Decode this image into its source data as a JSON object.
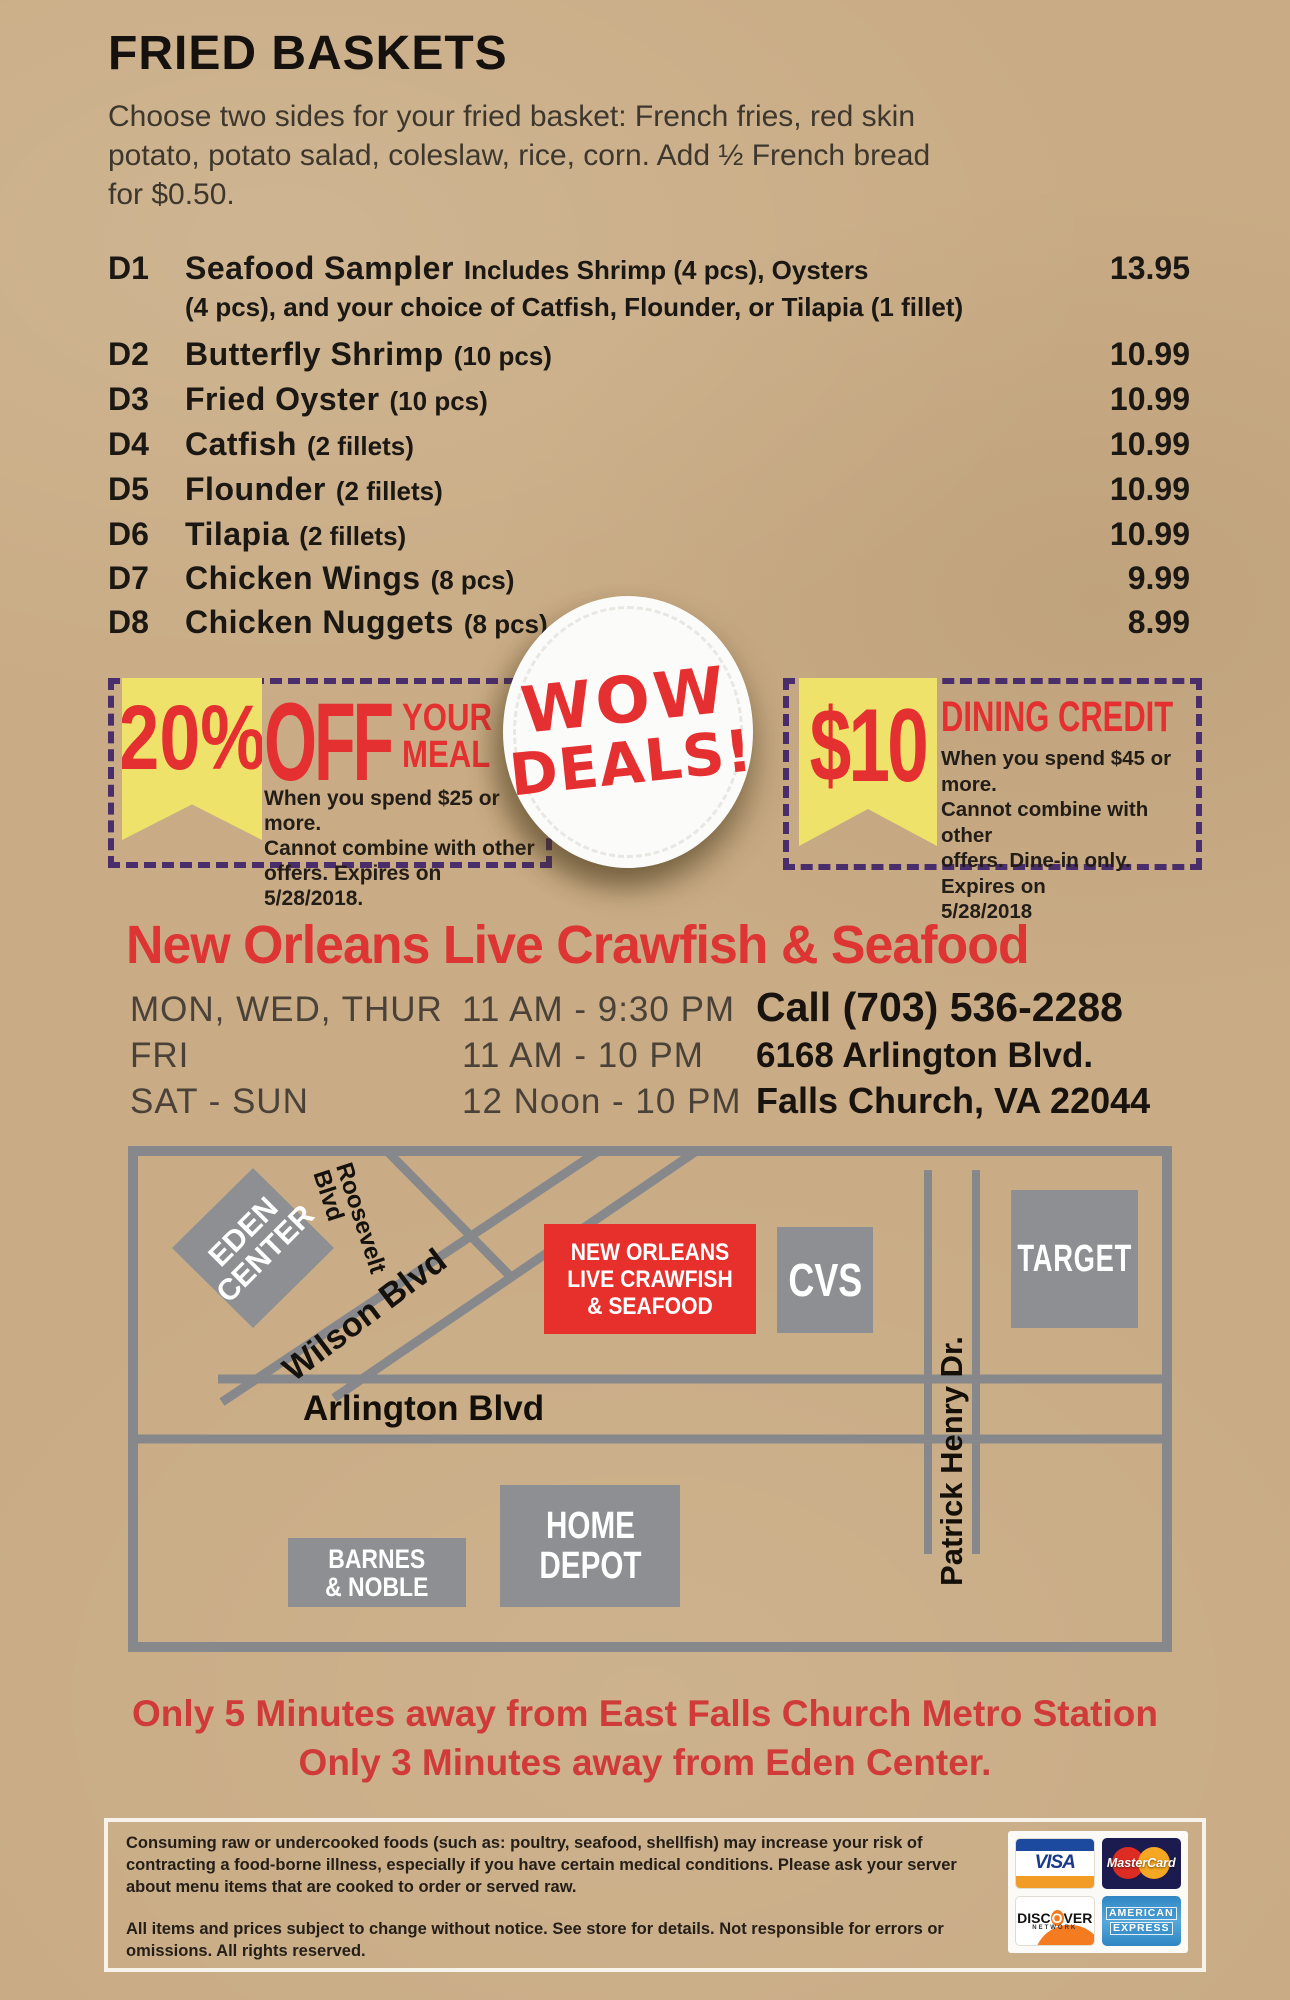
{
  "colors": {
    "accent_red": "#e43030",
    "coupon_yellow": "#efe26a",
    "coupon_purple": "#4a2d6b",
    "map_grey": "#8d8f92",
    "kraft_bg": "#c9ac85"
  },
  "fried_baskets": {
    "title": "FRIED BASKETS",
    "intro": [
      "Choose two sides for your fried basket: French fries, red skin",
      "potato, potato salad, coleslaw, rice, corn.  Add ½ French bread",
      "for $0.50."
    ],
    "items": [
      {
        "code": "D1",
        "name": "Seafood Sampler",
        "desc": "Includes  Shrimp (4 pcs), Oysters",
        "desc2": "(4 pcs), and your choice of Catfish, Flounder, or Tilapia (1 fillet)",
        "price": "13.95"
      },
      {
        "code": "D2",
        "name": "Butterfly Shrimp",
        "desc": "(10 pcs)",
        "price": "10.99"
      },
      {
        "code": "D3",
        "name": "Fried Oyster",
        "desc": "(10 pcs)",
        "price": "10.99"
      },
      {
        "code": "D4",
        "name": "Catfish",
        "desc": "(2 fillets)",
        "price": "10.99"
      },
      {
        "code": "D5",
        "name": "Flounder",
        "desc": "(2 fillets)",
        "price": "10.99"
      },
      {
        "code": "D6",
        "name": "Tilapia",
        "desc": "(2 fillets)",
        "price": "10.99"
      },
      {
        "code": "D7",
        "name": "Chicken Wings",
        "desc": "(8 pcs)",
        "price": "9.99"
      },
      {
        "code": "D8",
        "name": "Chicken Nuggets",
        "desc": "(8 pcs)",
        "price": "8.99"
      }
    ]
  },
  "coupons": {
    "left": {
      "big": "20%",
      "off": "OFF",
      "your": "YOUR",
      "meal": "MEAL",
      "lines": [
        "When you spend $25 or more.",
        "Cannot combine with other",
        "offers. Expires on 5/28/2018."
      ]
    },
    "badge": {
      "line1": "WOW",
      "line2": "DEALS!"
    },
    "right": {
      "big": "$10",
      "title": "DINING CREDIT",
      "lines": [
        "When you spend $45 or more.",
        "Cannot combine with other",
        "offers. Dine-in only. Expires on",
        "5/28/2018"
      ]
    }
  },
  "restaurant": {
    "name": "New Orleans Live Crawfish & Seafood",
    "hours": [
      {
        "days": "MON, WED, THUR",
        "time": "11 AM - 9:30 PM"
      },
      {
        "days": "FRI",
        "time": "11 AM - 10 PM"
      },
      {
        "days": "SAT - SUN",
        "time": "12 Noon - 10 PM"
      }
    ],
    "phone": "Call (703) 536-2288",
    "address1": "6168 Arlington Blvd.",
    "address2": "Falls Church, VA 22044"
  },
  "map": {
    "eden1": "EDEN",
    "eden2": "CENTER",
    "roosevelt1": "Roosevelt",
    "roosevelt2": "Blvd",
    "wilson": "Wilson Blvd",
    "arlington": "Arlington Blvd",
    "patrick": "Patrick Henry Dr.",
    "restaurant1": "NEW ORLEANS",
    "restaurant2": "LIVE CRAWFISH",
    "restaurant3": "& SEAFOOD",
    "cvs": "CVS",
    "target": "TARGET",
    "home1": "HOME",
    "home2": "DEPOT",
    "barnes1": "BARNES",
    "barnes2": "& NOBLE"
  },
  "footer_notes": {
    "line1": "Only 5 Minutes away from East Falls Church Metro Station",
    "line2": "Only 3 Minutes away from Eden Center."
  },
  "disclaimer": {
    "p1": "Consuming raw or undercooked foods (such as: poultry, seafood, shellfish) may increase your risk of contracting a food-borne illness, especially if you have certain medical conditions. Please ask your server about menu items that are cooked to order or served raw.",
    "p2": "All items and prices subject to change without notice.  See store for details. Not responsible for errors or omissions.  All rights reserved."
  },
  "cards": {
    "visa": "VISA",
    "mastercard": "MasterCard",
    "discover_pre": "DISC",
    "discover_o": "O",
    "discover_post": "VER",
    "discover_sub": "NETWORK",
    "amex1": "AMERICAN",
    "amex2": "EXPRESS"
  }
}
